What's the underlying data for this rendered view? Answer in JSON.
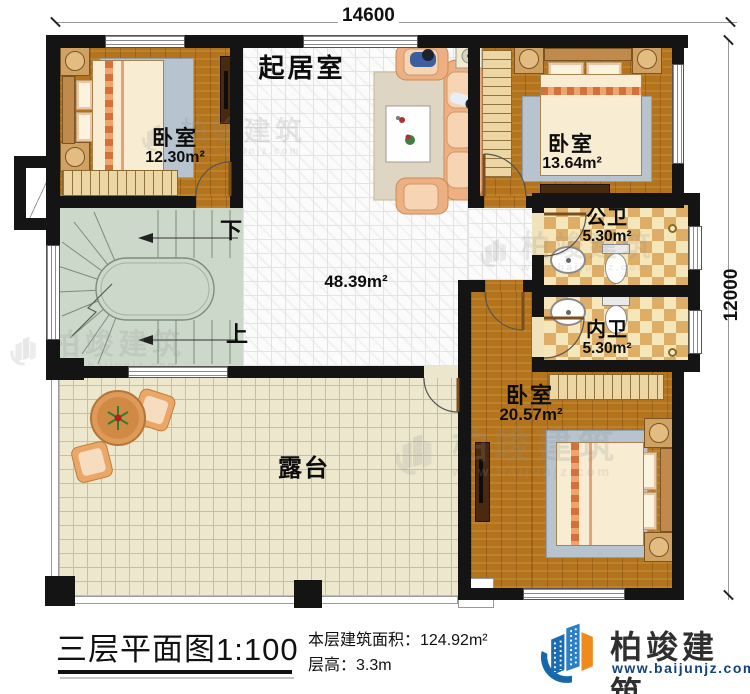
{
  "dims": {
    "top": "14600",
    "right": "12000"
  },
  "rooms": {
    "living": {
      "name": "起居室",
      "area": "48.39m²"
    },
    "bedroom1": {
      "name": "卧室",
      "area": "12.30m²"
    },
    "bedroom2": {
      "name": "卧室",
      "area": "13.64m²"
    },
    "bedroom3": {
      "name": "卧室",
      "area": "20.57m²"
    },
    "public_bath": {
      "name": "公卫",
      "area": "5.30m²"
    },
    "ensuite_bath": {
      "name": "内卫",
      "area": "5.30m²"
    },
    "terrace": {
      "name": "露台"
    }
  },
  "stairs": {
    "down": "下",
    "up": "上"
  },
  "footer": {
    "title": "三层平面图1:100",
    "building_area": "本层建筑面积：124.92m²",
    "floor_height": "层高：3.3m"
  },
  "logo": {
    "name": "柏竣建筑",
    "url": "www.baijunjz.com"
  },
  "watermark": {
    "text": "柏竣建筑",
    "url": "www.baijunjz.com"
  },
  "colors": {
    "wall": "#141414",
    "wood_floor": "#b3741d",
    "tile_floor": "#fbfbfb",
    "bath_tile_dark": "#dfae66",
    "bath_tile_light": "#f6e7bb",
    "stairs": "#ccd8ca",
    "terrace": "#ede7cd",
    "logo_blue": "#1b6db3",
    "logo_orange": "#ef8b1d",
    "logo_url_navy": "#14427a"
  }
}
